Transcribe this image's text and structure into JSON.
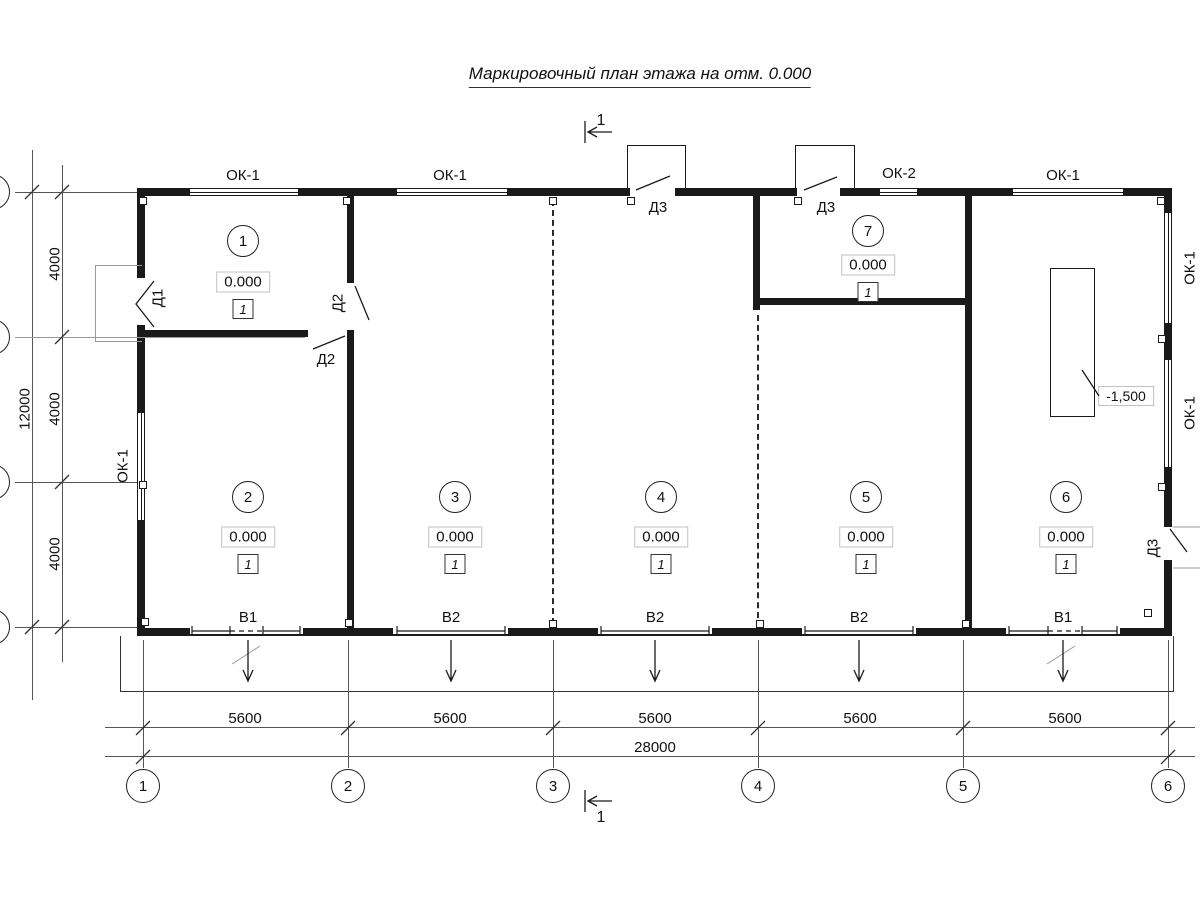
{
  "title": "Маркировочный план этажа на отм. 0.000",
  "section_label": "1",
  "rooms": [
    {
      "number": "1",
      "elevation": "0.000",
      "finish": "1"
    },
    {
      "number": "2",
      "elevation": "0.000",
      "finish": "1"
    },
    {
      "number": "3",
      "elevation": "0.000",
      "finish": "1"
    },
    {
      "number": "4",
      "elevation": "0.000",
      "finish": "1"
    },
    {
      "number": "5",
      "elevation": "0.000",
      "finish": "1"
    },
    {
      "number": "6",
      "elevation": "0.000",
      "finish": "1"
    },
    {
      "number": "7",
      "elevation": "0.000",
      "finish": "1"
    }
  ],
  "openings": {
    "top_windows": [
      "ОК-1",
      "ОК-1",
      "ОК-2",
      "ОК-1"
    ],
    "left_window": "ОК-1",
    "right_windows": [
      "ОК-1",
      "ОК-1"
    ],
    "doors": {
      "d1": "Д1",
      "d2_vertical": "Д2",
      "d2_horizontal": "Д2",
      "d3_top_left": "Д3",
      "d3_top_right": "Д3",
      "d3_right": "Д3"
    }
  },
  "drains": [
    "В1",
    "В2",
    "В2",
    "В2",
    "В1"
  ],
  "pit": {
    "elevation": "-1,500"
  },
  "dims": {
    "bay": [
      "5600",
      "5600",
      "5600",
      "5600",
      "5600"
    ],
    "total_width": "28000",
    "row": [
      "4000",
      "4000",
      "4000"
    ],
    "total_height": "12000"
  },
  "grid_columns": [
    "1",
    "2",
    "3",
    "4",
    "5",
    "6"
  ]
}
